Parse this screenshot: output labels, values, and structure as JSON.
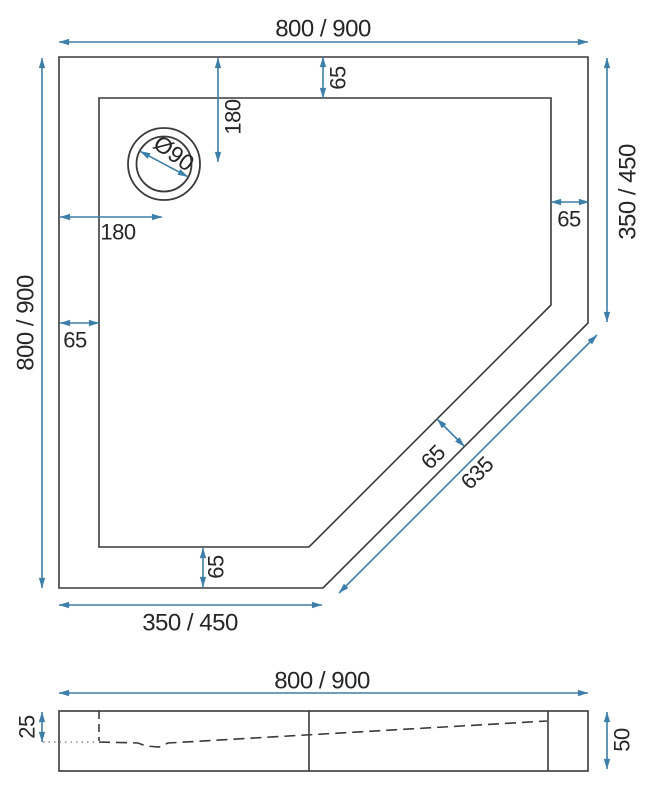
{
  "colors": {
    "dimension": "#3d7fa8",
    "outline": "#3a3a3a",
    "label": "#262626",
    "reference": "#8a8a8a",
    "background": "#ffffff"
  },
  "plan": {
    "width_top": "800 / 900",
    "height_left": "800 / 900",
    "right_height": "350 / 450",
    "bottom_width": "350 / 450",
    "rim_top": "65",
    "rim_left": "65",
    "rim_right": "65",
    "rim_bottom": "65",
    "rim_diagonal": "65",
    "diagonal_length": "635",
    "drain_offset_top": "180",
    "drain_offset_left": "180",
    "drain_diameter": "Ø90"
  },
  "section": {
    "width": "800 / 900",
    "basin_depth": "25",
    "total_height": "50"
  }
}
